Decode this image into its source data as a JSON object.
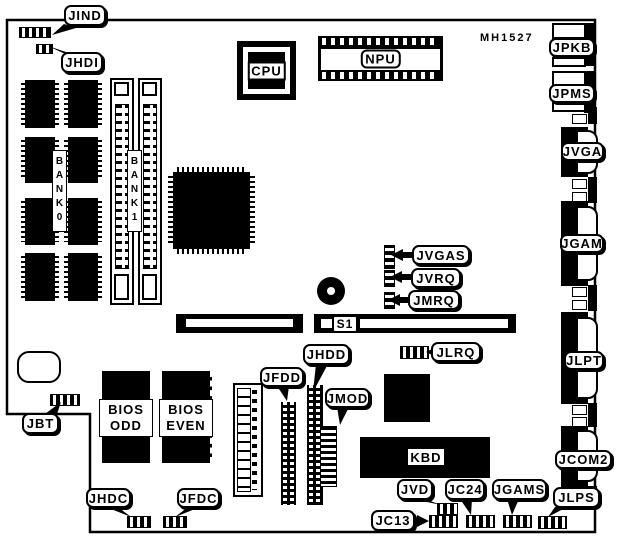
{
  "board": {
    "part_number": "MH1527"
  },
  "chips": {
    "cpu": "CPU",
    "npu": "NPU",
    "kbd": "KBD",
    "bios_odd": "BIOS\nODD",
    "bios_even": "BIOS\nEVEN",
    "bank0": "BANK0",
    "bank1": "BANK1"
  },
  "slots": {
    "s1": "S1"
  },
  "jumpers": {
    "jind": "JIND",
    "jhdi": "JHDI",
    "jvgas": "JVGAS",
    "jvrq": "JVRQ",
    "jmrq": "JMRQ",
    "jlrq": "JLRQ",
    "jbt": "JBT",
    "jhdc": "JHDC",
    "jfdc": "JFDC",
    "jc13": "JC13",
    "jvd": "JVD",
    "jc24": "JC24",
    "jgams": "JGAMS",
    "jlps": "JLPS",
    "jhdd": "JHDD",
    "jfdd": "JFDD",
    "jmod": "JMOD"
  },
  "connectors": {
    "jpkb": "JPKB",
    "jpms": "JPMS",
    "jvga": "JVGA",
    "jgam": "JGAM",
    "jlpt": "JLPT",
    "jcom2": "JCOM2"
  }
}
